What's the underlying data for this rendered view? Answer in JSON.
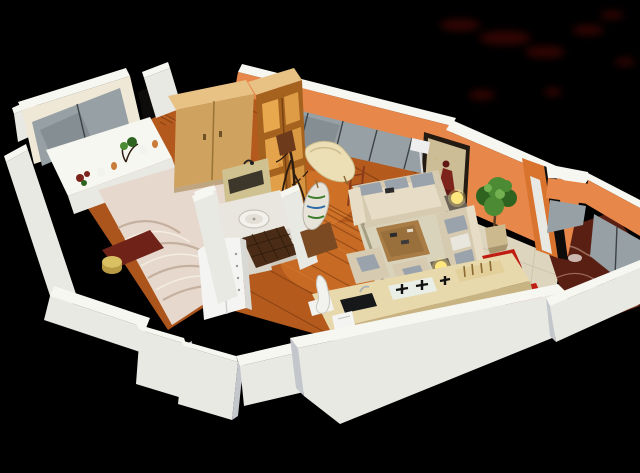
{
  "scene": {
    "name": "3D isometric apartment floor plan render",
    "width": 640,
    "height": 473,
    "rooms": [
      {
        "id": "bedroom",
        "label": "bedroom"
      },
      {
        "id": "hallway",
        "label": "hallway"
      },
      {
        "id": "bathroom",
        "label": "bathroom"
      },
      {
        "id": "living-room",
        "label": "living room"
      },
      {
        "id": "dining-area",
        "label": "dining area"
      },
      {
        "id": "kitchen",
        "label": "kitchen"
      },
      {
        "id": "balcony",
        "label": "balcony"
      }
    ],
    "objects": [
      "bedroom-window",
      "window-sill-plants",
      "double-bed",
      "bed-bench",
      "yellow-stool",
      "wardrobe",
      "display-cabinet",
      "decorative-branch",
      "mirror-cabinet",
      "washbasin",
      "washing-machine",
      "mosaic-tiles",
      "chaise-lounge",
      "floor-lamp",
      "wall-picture",
      "potted-plant",
      "long-sofa",
      "chaise-sofa",
      "armchairs",
      "area-rug",
      "coffee-table",
      "ball-lamps",
      "tv-decor-stand",
      "ladder-shelf",
      "dining-table",
      "red-stools",
      "kitchen-counter",
      "gas-stove",
      "kitchen-sink",
      "white-sculpture",
      "balcony-glazing"
    ]
  },
  "palette": {
    "bg": "#000000",
    "smudge": "#5a0b07",
    "lightPool": "#ff9c3a",
    "wallFace": "#e9e9e4",
    "wallTop": "#f7f7f2",
    "wallShade": "#c3c7cc",
    "creamWall": "#efe8d6",
    "doorGap": "#0e0c0a",
    "woodFloor": "#b45a1d",
    "woodLight": "#e89a4a",
    "plankLine": "#5f2a0c",
    "orangeWall": "#e8874a",
    "orangeDeep": "#d9742f",
    "glassPane": "#97a0a5",
    "glassDark": "#6f787e",
    "mullion": "#3c4246",
    "wardrobeFront": "#cfa25f",
    "wardrobeTop": "#e8c185",
    "wardrobeSeam": "#9a7236",
    "cabinetWood": "#a5621e",
    "cabinetGlow": "#f0b053",
    "branchBrown": "#2e1d10",
    "bedSheet": "#e6d8cc",
    "bedShadow": "#bda693",
    "bedHighlight": "#f4ece2",
    "bedMint": "#cfe3c0",
    "benchRed": "#6e2218",
    "stoolYellow": "#d9c063",
    "marbleCounter": "#e9e6df",
    "mirrorBeige": "#cfc190",
    "mosaicTile": "#4a2c16",
    "applianceWhite": "#f4f4f2",
    "sofaBeige": "#d6cab0",
    "sofaLight": "#e7ddc6",
    "cushionGray": "#9aa3ac",
    "rugBeige": "#d9d3bb",
    "rugBorder": "#9b9478",
    "tableWood": "#a87c44",
    "sideTableDark": "#6b6258",
    "lampYellow": "#ffe77e",
    "pictureFrame": "#231a11",
    "artBeige": "#cdbd97",
    "artRed": "#7c241c",
    "artDark": "#5f1813",
    "plantGreen": "#4c8a33",
    "plantDark": "#2f6420",
    "plantLight": "#73b050",
    "potBeige": "#cdb98e",
    "tileFloor": "#ddd5bd",
    "tileLine": "#bfb69c",
    "stoolRed": "#bf1d12",
    "stoolRedDark": "#8e120a",
    "counterTop": "#e8d9ad",
    "counterSide": "#c8b382",
    "stoveWhite": "#e9efe6",
    "sinkBlack": "#17181a",
    "bottleShelf": "#e2cf9a",
    "sculptureWhite": "#f2f2ee",
    "balconyFloor": "#5a1f13",
    "balconyVein": "#c8a08a"
  }
}
